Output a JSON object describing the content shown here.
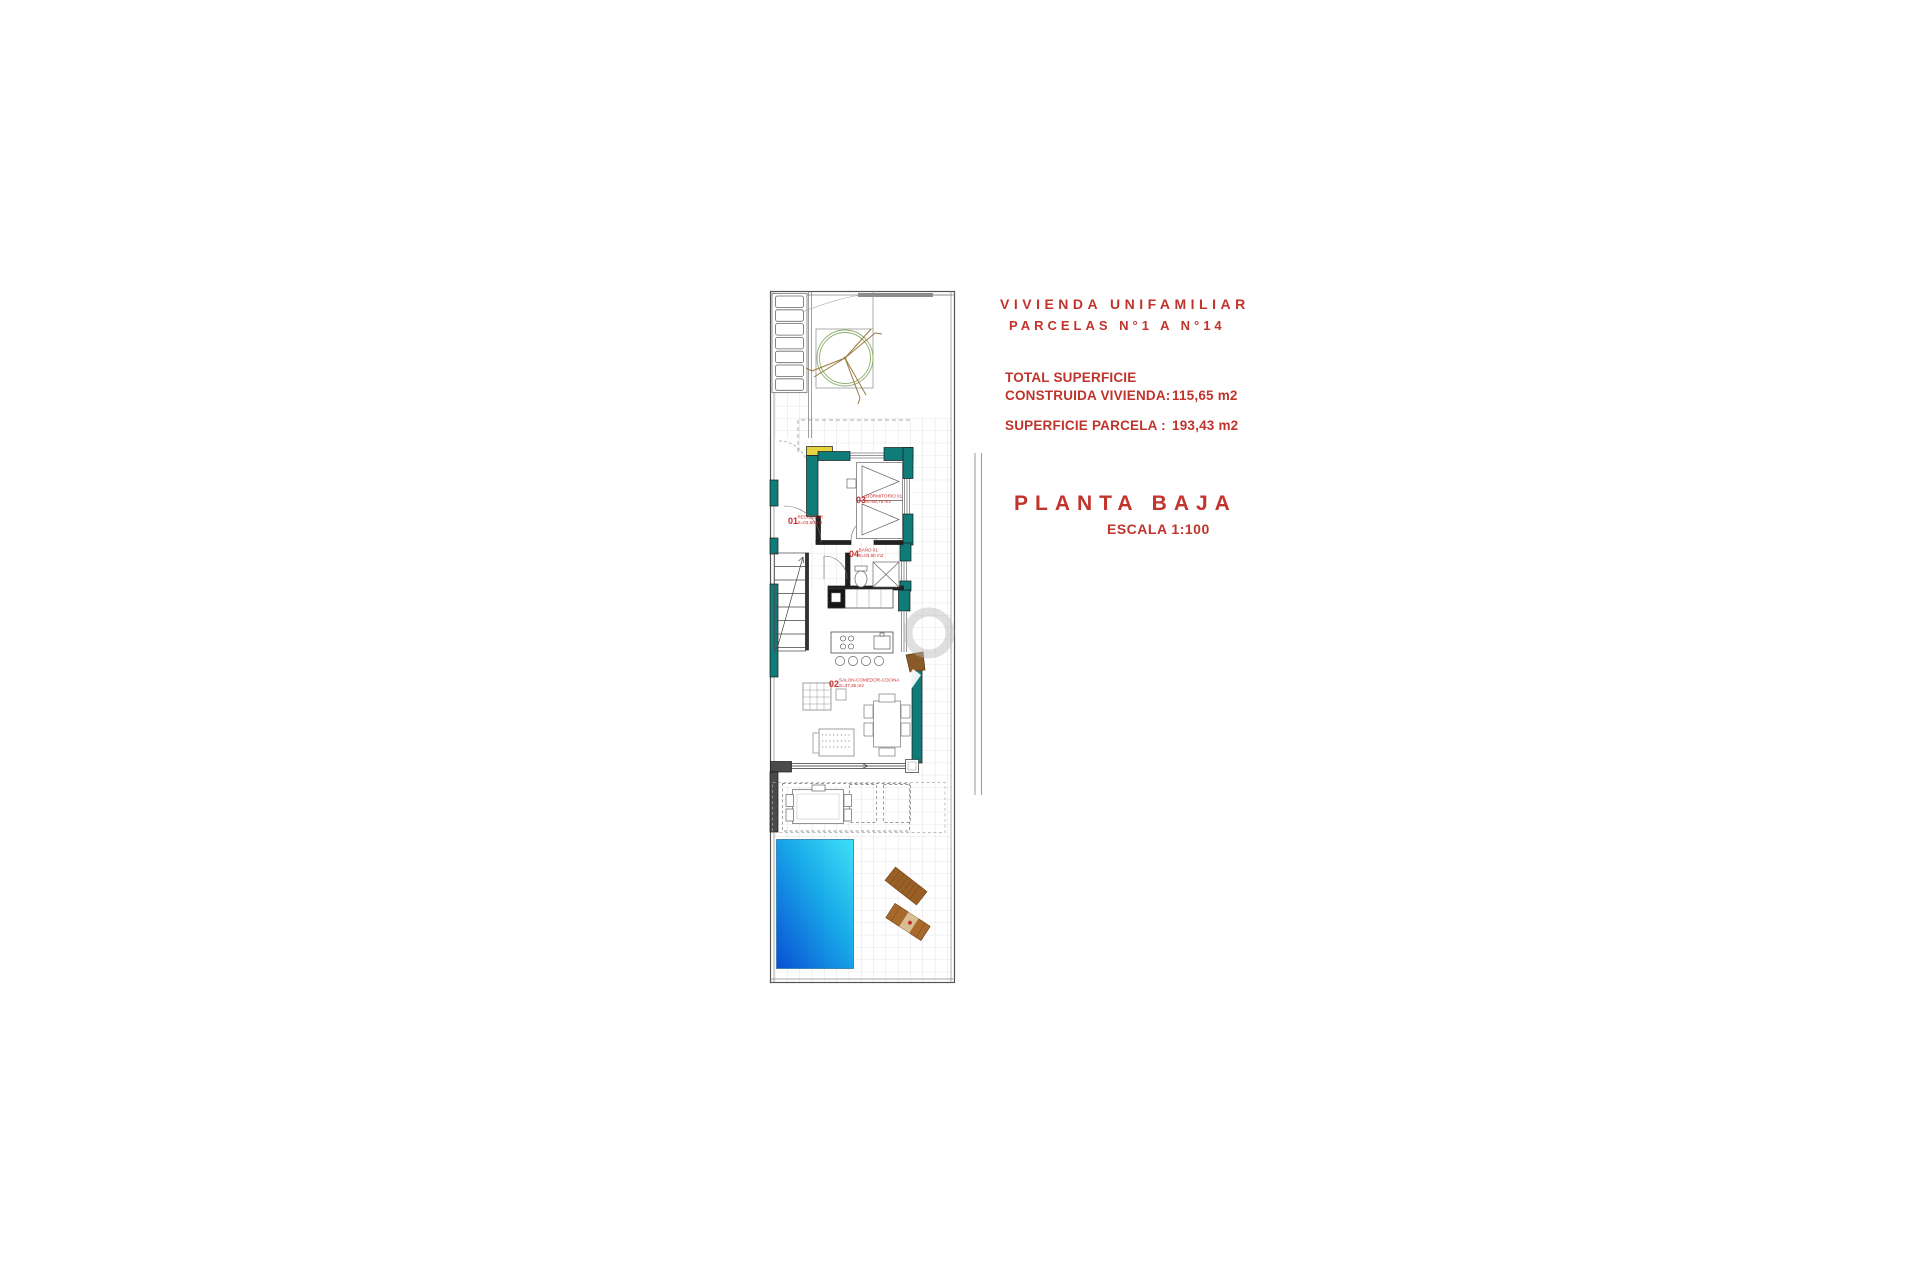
{
  "document": {
    "header": {
      "line1": "VIVIENDA UNIFAMILIAR",
      "line2": "PARCELAS N°1 A N°14"
    },
    "areas": {
      "total_label_line1": "TOTAL SUPERFICIE",
      "total_label_line2": "CONSTRUIDA VIVIENDA:",
      "total_value": "115,65 m2",
      "parcel_label": "SUPERFICIE PARCELA :",
      "parcel_value": "193,43 m2"
    },
    "plan_title": "PLANTA BAJA",
    "plan_scale": "ESCALA 1:100",
    "accent_color": "#c0342c"
  },
  "floor_plan": {
    "rooms": [
      {
        "number": "01",
        "name": "RECIBIDOR",
        "area": "S=03,50 m2"
      },
      {
        "number": "02",
        "name": "SALON-COMEDOR-COCINA",
        "area": "S=37,35 m2"
      },
      {
        "number": "03",
        "name": "DORMITORIO 01",
        "area": "S=08,75 m2"
      },
      {
        "number": "04",
        "name": "BAÑO 01",
        "area": "S=03,60 m2"
      }
    ],
    "colors": {
      "wall_teal": "#0f7c7a",
      "pool_deep": "#0a4fd4",
      "pool_shallow": "#3fe0f8",
      "tile_grid": "#cfcfcf",
      "lounger_wood": "#9a5f26",
      "label_red": "#cc2b2b",
      "accent_yellow": "#e6d23e"
    }
  }
}
